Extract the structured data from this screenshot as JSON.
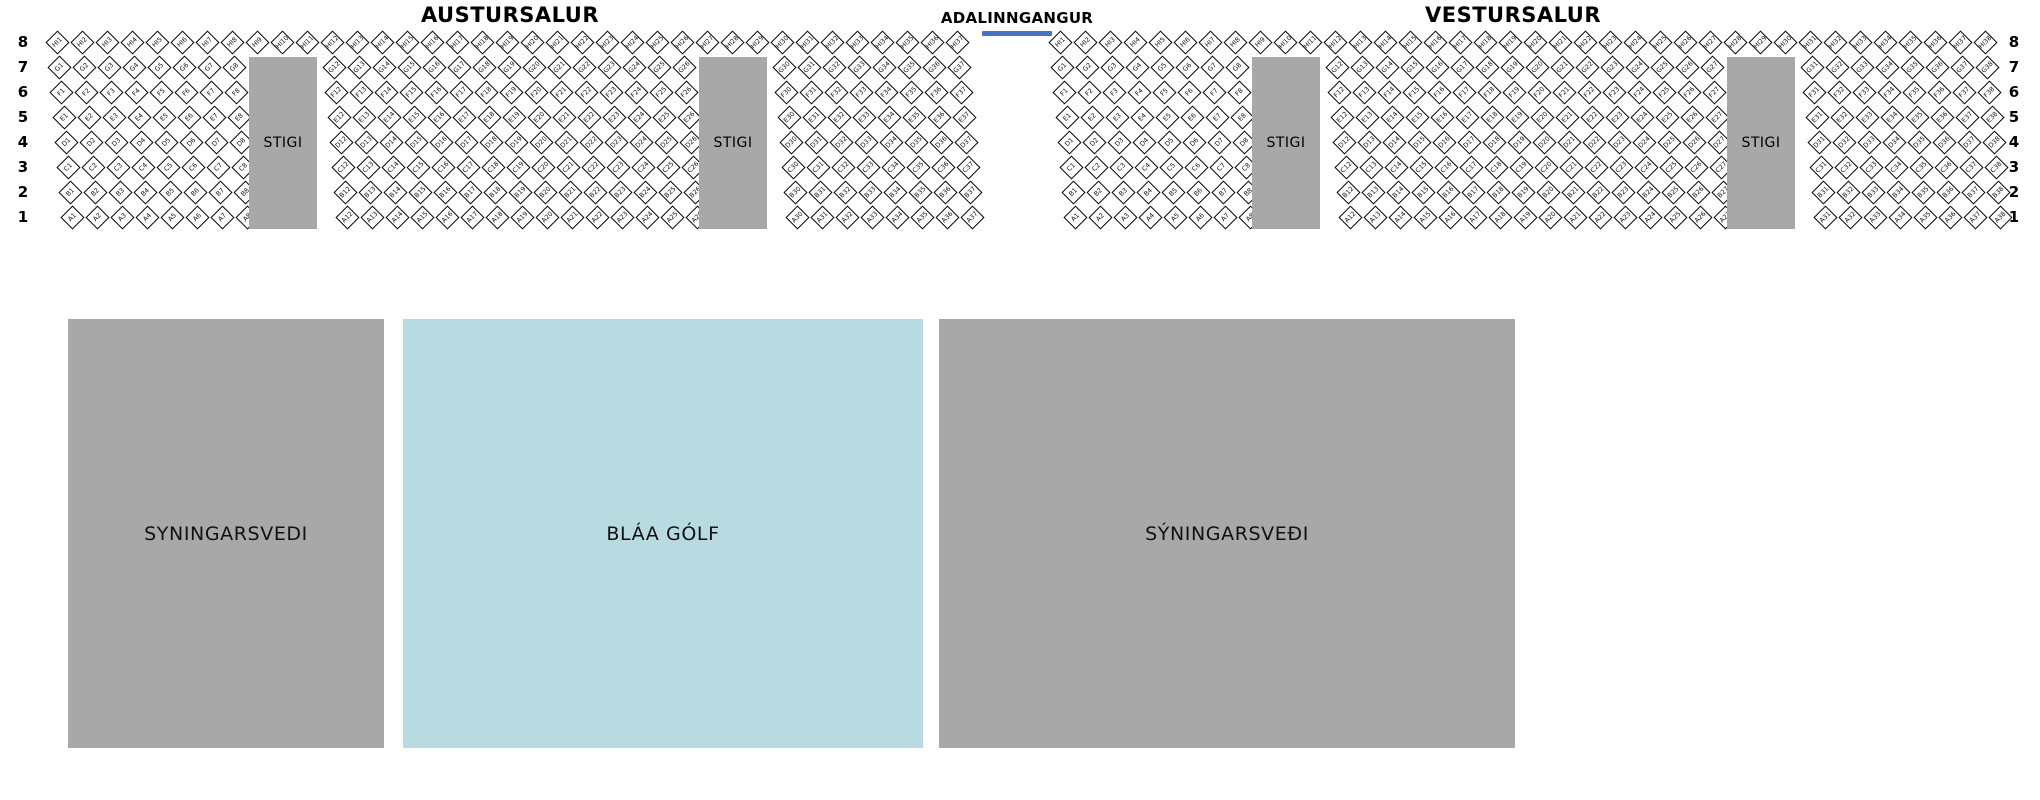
{
  "titles": {
    "east_hall": "AUSTURSALUR",
    "main_entrance": "ADALINNGANGUR",
    "west_hall": "VESTURSALUR"
  },
  "row_numbers": [
    "8",
    "7",
    "6",
    "5",
    "4",
    "3",
    "2",
    "1"
  ],
  "stair_label": "STIGI",
  "colors": {
    "stair_gray": "#a8a8a8",
    "floor_gray": "#a8a8a8",
    "floor_blue": "#b8dbe2",
    "entrance_line_blue": "#4472c4",
    "seat_fill": "#ffffff",
    "seat_border": "#000000"
  },
  "sections": [
    {
      "id": "austursalur",
      "top_row": {
        "row_number": "8",
        "prefix": "HI",
        "from": 1,
        "to": 37
      },
      "lower_rows": [
        {
          "row_number": "7",
          "prefix": "G"
        },
        {
          "row_number": "6",
          "prefix": "F"
        },
        {
          "row_number": "5",
          "prefix": "E"
        },
        {
          "row_number": "4",
          "prefix": "D"
        },
        {
          "row_number": "3",
          "prefix": "C"
        },
        {
          "row_number": "2",
          "prefix": "B"
        },
        {
          "row_number": "1",
          "prefix": "A"
        }
      ],
      "seat_groups": [
        {
          "from": 1,
          "to": 8
        },
        {
          "from": 12,
          "to": 26
        },
        {
          "from": 30,
          "to": 37
        }
      ],
      "stair_cell_offsets": [
        8,
        26
      ]
    },
    {
      "id": "vestursalur",
      "top_row": {
        "row_number": "8",
        "prefix": "HI",
        "from": 1,
        "to": 38
      },
      "lower_rows": [
        {
          "row_number": "7",
          "prefix": "G"
        },
        {
          "row_number": "6",
          "prefix": "F"
        },
        {
          "row_number": "5",
          "prefix": "E"
        },
        {
          "row_number": "4",
          "prefix": "D"
        },
        {
          "row_number": "3",
          "prefix": "C"
        },
        {
          "row_number": "2",
          "prefix": "B"
        },
        {
          "row_number": "1",
          "prefix": "A"
        }
      ],
      "seat_groups": [
        {
          "from": 1,
          "to": 8
        },
        {
          "from": 12,
          "to": 27
        },
        {
          "from": 31,
          "to": 38
        }
      ],
      "stair_cell_offsets": [
        8,
        27
      ]
    }
  ],
  "floor_areas": [
    {
      "label": "SYNINGARSVEDI",
      "fill": "floor_gray"
    },
    {
      "label": "BLÁA GÓLF",
      "fill": "floor_blue"
    },
    {
      "label": "SÝNINGARSVEÐI",
      "fill": "floor_gray"
    }
  ]
}
